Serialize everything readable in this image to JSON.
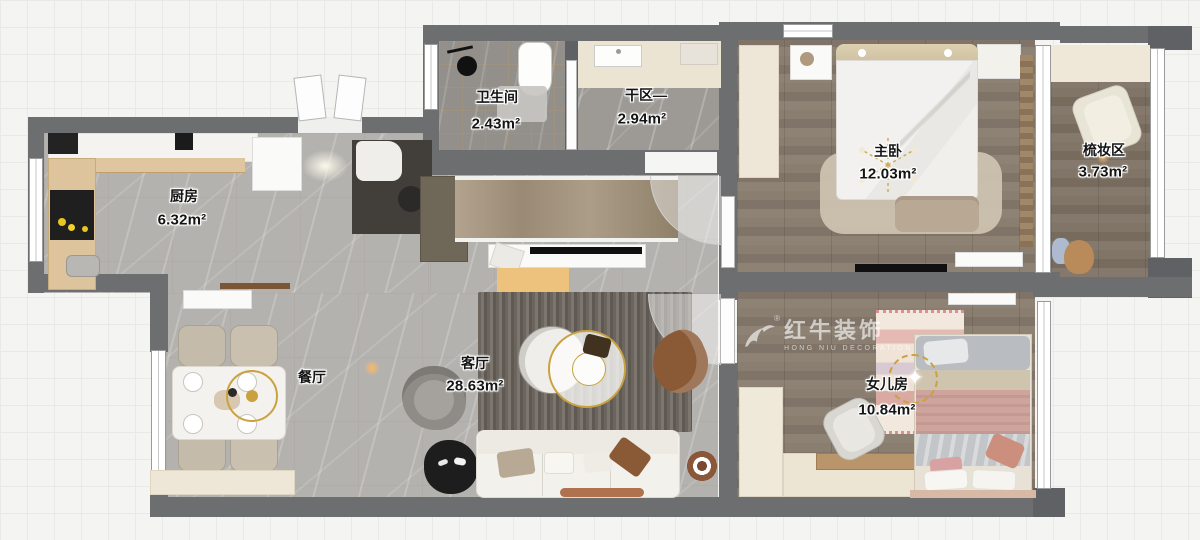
{
  "rooms": {
    "bathroom": {
      "label": "卫生间",
      "area": "2.43m²"
    },
    "dry_area": {
      "label": "干区—",
      "area": "2.94m²"
    },
    "master_bedroom": {
      "label": "主卧",
      "area": "12.03m²"
    },
    "dressing_area": {
      "label": "梳妆区",
      "area": "3.73m²"
    },
    "kitchen": {
      "label": "厨房",
      "area": "6.32m²"
    },
    "dining_room": {
      "label": "餐厅"
    },
    "living_room": {
      "label": "客厅",
      "area": "28.63m²"
    },
    "daughter_room": {
      "label": "女儿房",
      "area": "10.84m²"
    }
  },
  "watermark": {
    "brand": "红牛装饰",
    "sub": "HONG NIU DECORATION",
    "registered": "®"
  },
  "colors": {
    "wall": "#6d6e70",
    "gold": "#c9a23f",
    "wood_floor": "#877b6d",
    "tile_floor": "#b4b2ae"
  }
}
